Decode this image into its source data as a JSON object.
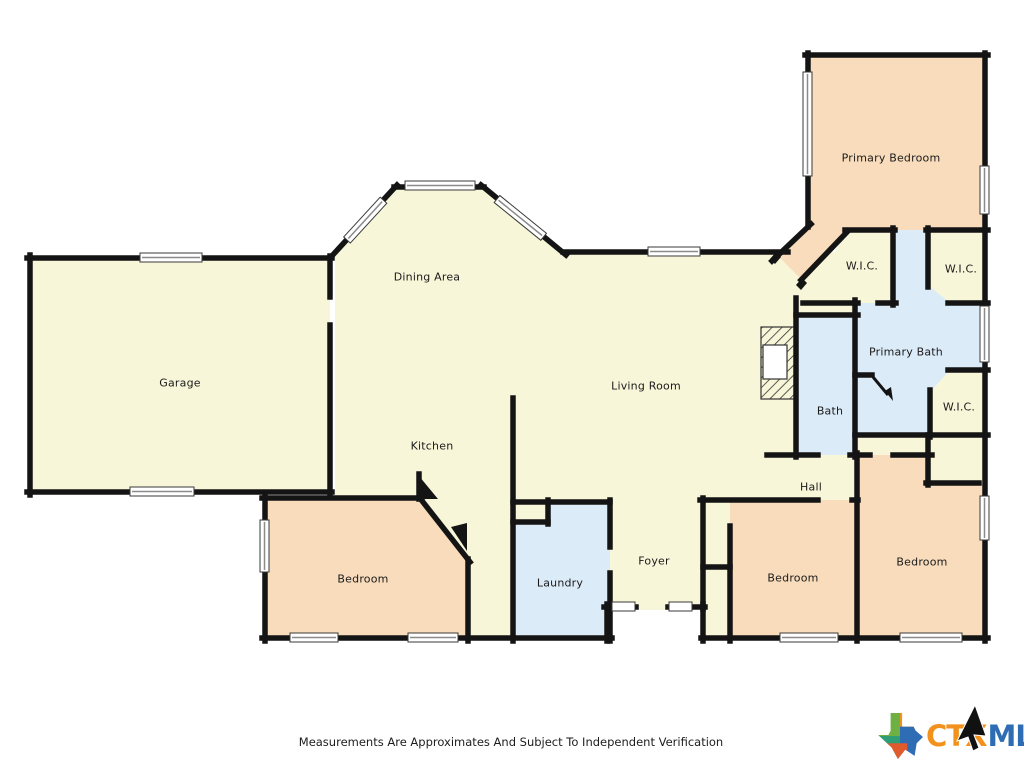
{
  "rooms": {
    "garage": {
      "label": "Garage"
    },
    "dining": {
      "label": "Dining Area"
    },
    "kitchen": {
      "label": "Kitchen"
    },
    "living": {
      "label": "Living Room"
    },
    "primary_bedroom": {
      "label": "Primary Bedroom"
    },
    "primary_bath": {
      "label": "Primary Bath"
    },
    "bath": {
      "label": "Bath"
    },
    "hall": {
      "label": "Hall"
    },
    "laundry": {
      "label": "Laundry"
    },
    "foyer": {
      "label": "Foyer"
    },
    "wic_left": {
      "label": "W.I.C."
    },
    "wic_top_right": {
      "label": "W.I.C."
    },
    "wic_bottom_right": {
      "label": "W.I.C."
    },
    "bedroom_left": {
      "label": "Bedroom"
    },
    "bedroom_middle": {
      "label": "Bedroom"
    },
    "bedroom_right": {
      "label": "Bedroom"
    }
  },
  "footer": {
    "disclaimer": "Measurements Are Approximates And Subject To Independent Verification"
  },
  "logo": {
    "ctx": "CTX",
    "mls": "MLS"
  },
  "colors": {
    "room_cream": "#f8f6d9",
    "room_peach": "#f8dcbb",
    "room_blue": "#dcebf8",
    "wall": "#141414",
    "logo_orange": "#f2921d",
    "logo_blue": "#2e6db4"
  }
}
